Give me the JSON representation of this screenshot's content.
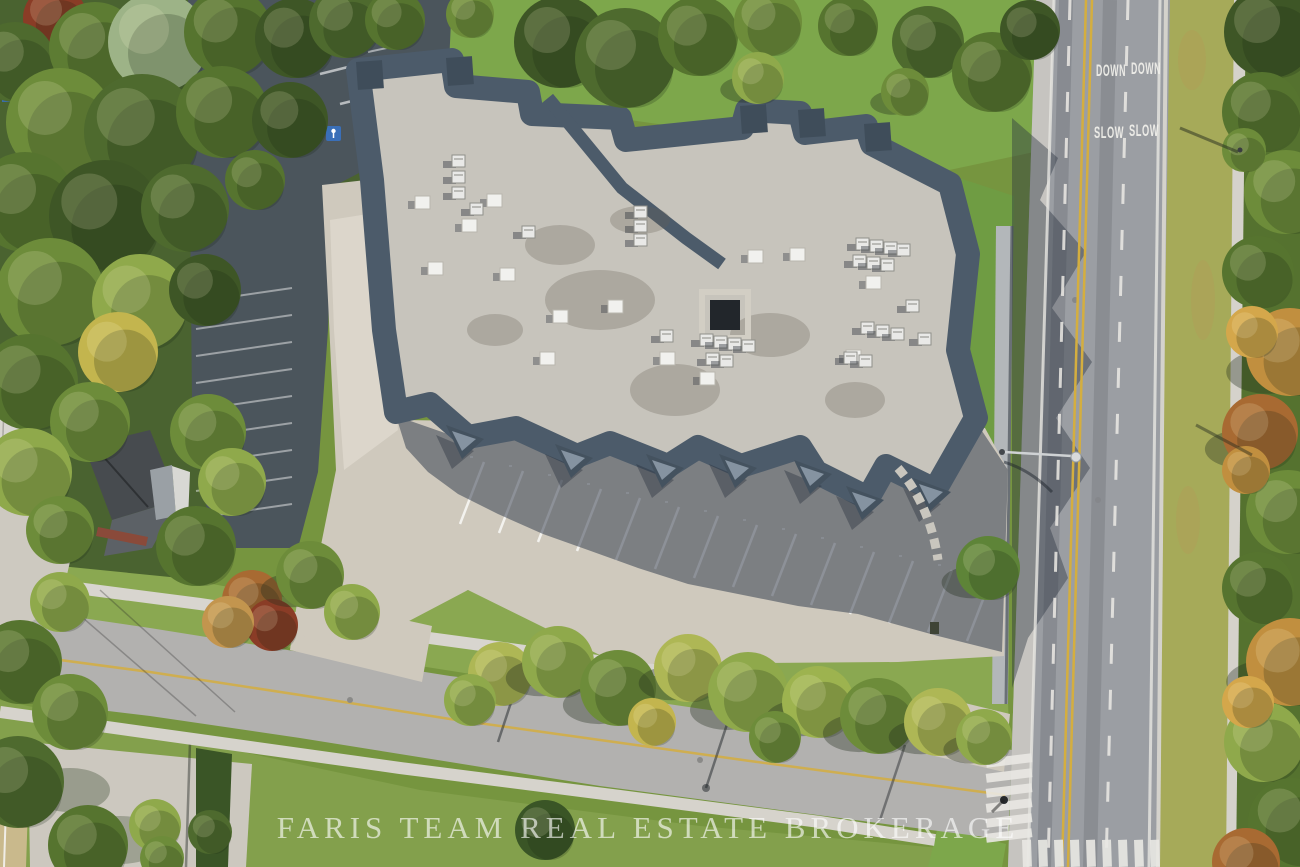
{
  "watermark": {
    "text": "FARIS TEAM REAL ESTATE BROKERAGE"
  },
  "road_paint": {
    "down_left": "DOWN",
    "down_right": "DOWN",
    "slow_left": "SLOW",
    "slow_right": "SLOW"
  },
  "colors": {
    "watermark_white": "#ffffff",
    "paint_white": "#f2f1ec",
    "centerline_yellow": "#d4ae3f",
    "asphalt_main_road": "#9b9ea3",
    "asphalt_dark_lot": "#4b555c",
    "concrete": "#cfc9bd",
    "roof_flat": "#c7c4bc",
    "roof_mansard": "#4c5b6a",
    "grass_bright": "#7da74b",
    "grass_olive": "#a6aa59",
    "handicap_blue": "#3a6fb8"
  }
}
